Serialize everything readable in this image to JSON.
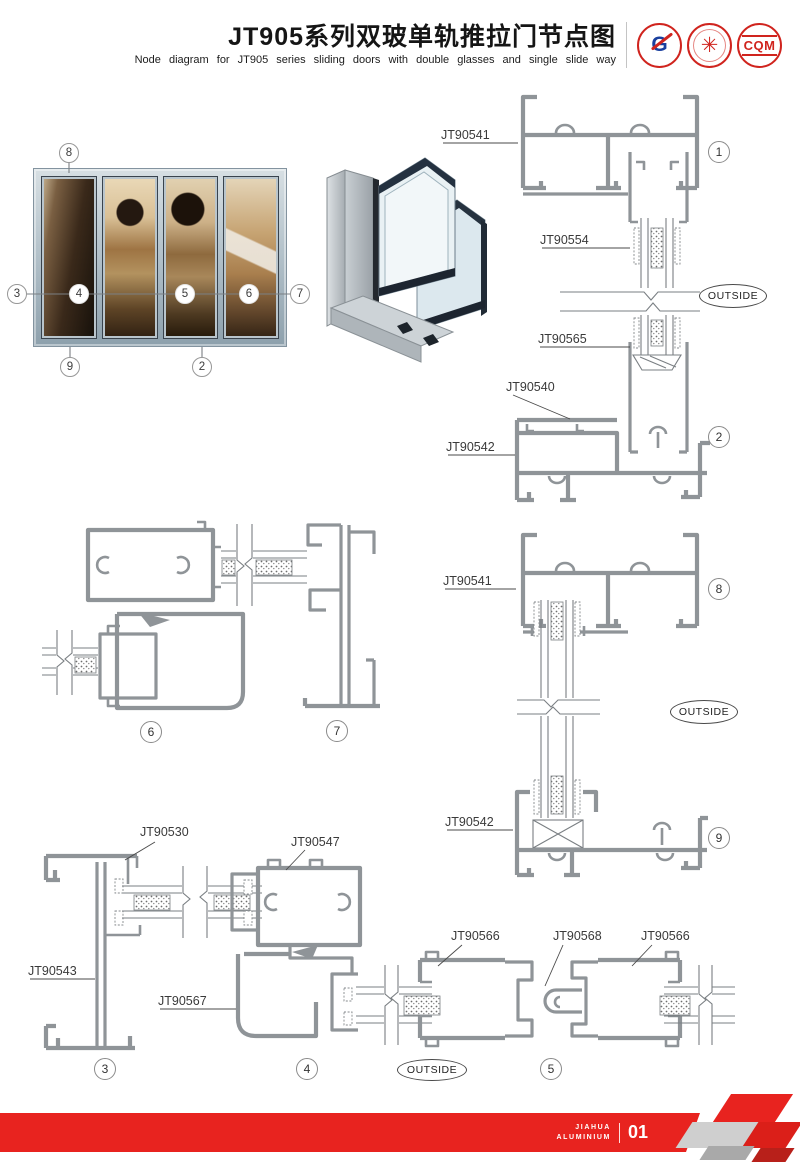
{
  "header": {
    "title": "JT905系列双玻单轨推拉门节点图",
    "subtitle": "Node diagram for JT905 series sliding doors with double glasses and single slide way",
    "logos": {
      "logo1_letter": "G",
      "logo2_glyph": "✳",
      "logo3_text": "CQM"
    }
  },
  "photo": {
    "callouts": {
      "c2": "2",
      "c3": "3",
      "c4": "4",
      "c5": "5",
      "c6": "6",
      "c7": "7",
      "c8": "8",
      "c9": "9"
    }
  },
  "drawings": {
    "parts": {
      "s1_rail": "JT90541",
      "s1_glass": "JT90554",
      "s2_glass": "JT90565",
      "s2_subrail": "JT90540",
      "s2_sill": "JT90542",
      "s8_rail": "JT90541",
      "s9_sill": "JT90542",
      "s3_cap": "JT90530",
      "s3_jamb": "JT90543",
      "s4_box": "JT90547",
      "s4_lower": "JT90567",
      "s5_left": "JT90566",
      "s5_center": "JT90568",
      "s5_right": "JT90566"
    },
    "outside_label": "OUTSIDE",
    "section_numbers": {
      "n1": "1",
      "n2": "2",
      "n3": "3",
      "n4": "4",
      "n5": "5",
      "n6": "6",
      "n7": "7",
      "n8": "8",
      "n9": "9"
    }
  },
  "footer": {
    "brand_line1": "JIAHUA",
    "brand_line2": "ALUMINIUM",
    "page_number": "01"
  },
  "colors": {
    "accent_red": "#e8231f",
    "profile_gray": "#8f9498"
  }
}
